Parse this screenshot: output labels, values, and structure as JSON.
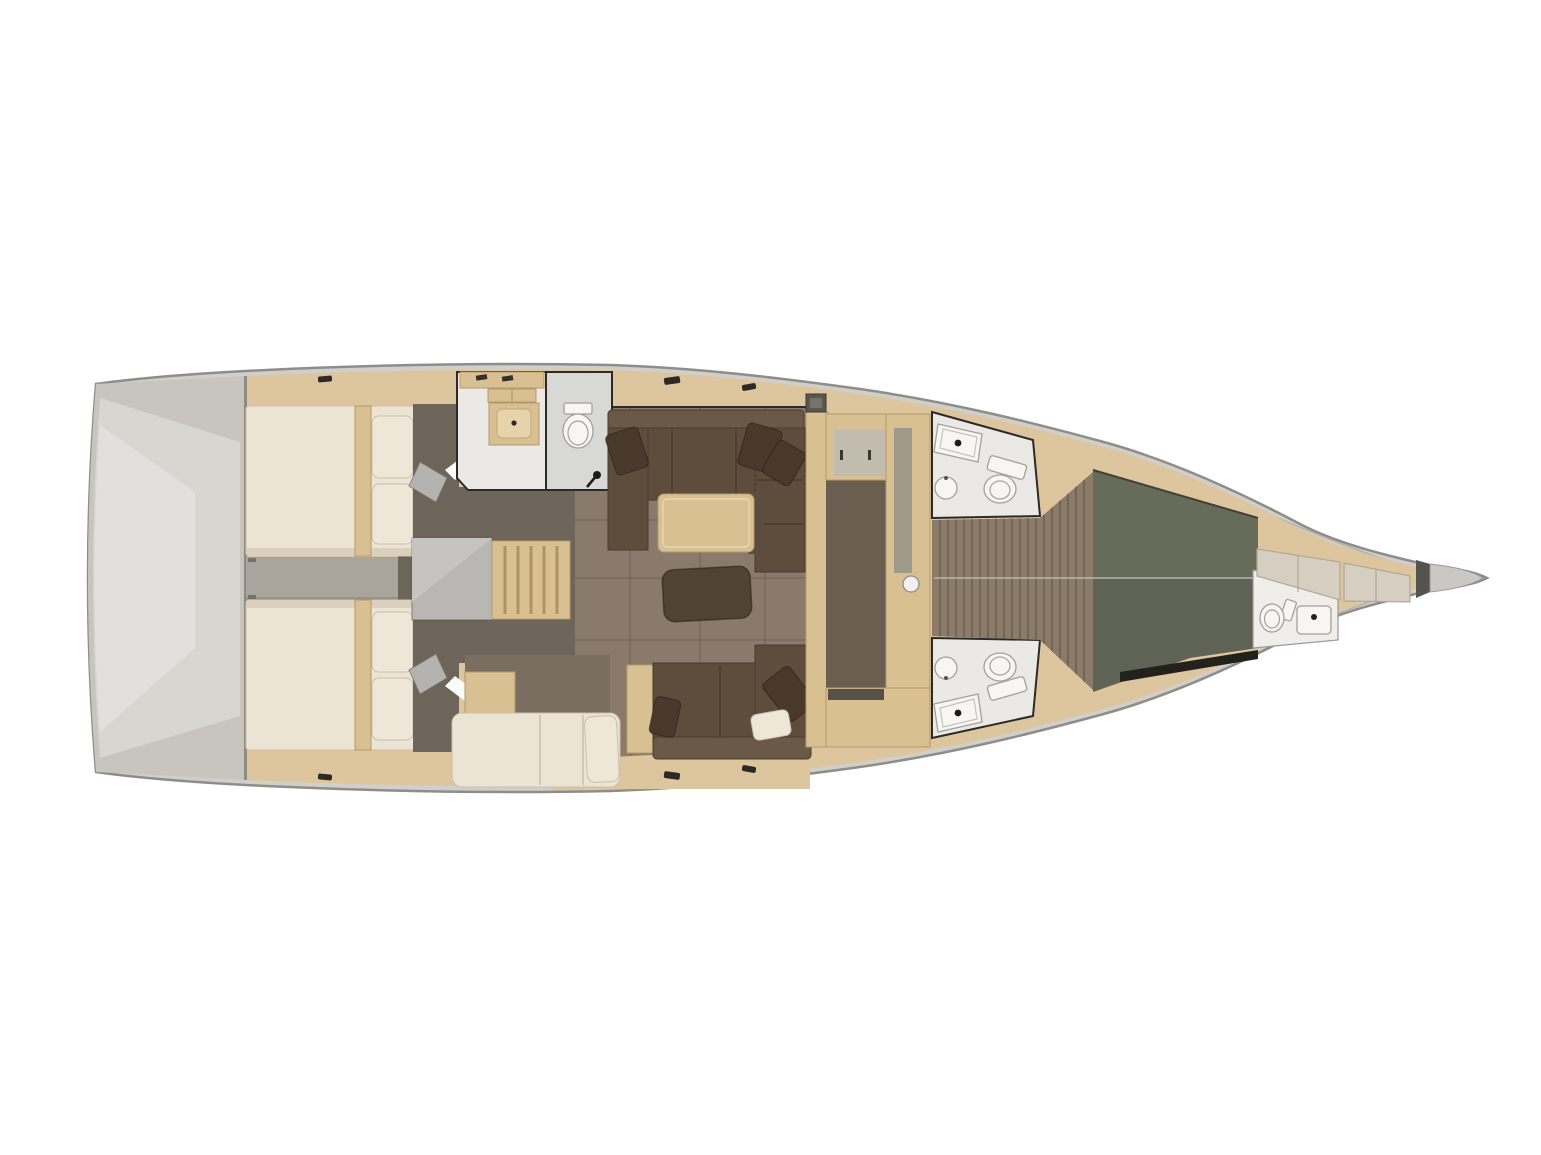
{
  "labels": {
    "plan": "sailing-yacht-interior-layout-plan",
    "hull": "hull-outline",
    "transom": "stern-swim-platform",
    "aft_cabin_top": "aft-double-cabin-port",
    "aft_cabin_bottom": "aft-double-cabin-starboard",
    "engine": "engine-compartment-corridor",
    "aft_head": "aft-bathroom-with-shower",
    "companionway": "companionway-steps",
    "nav": "chart-table-and-settee",
    "salon": "salon-seating-area",
    "galley": "galley",
    "head_top": "midship-bathroom-port",
    "head_bottom": "midship-bathroom-starboard",
    "walkway": "owner-cabin-walkway",
    "fwd_cabin": "owner-cabin-double-berth",
    "fwd_head": "bow-crew-compartment",
    "bow": "anchor-locker"
  },
  "palette": {
    "bg": "#ffffff",
    "hull_rim": "#d1cfcb",
    "hull_line": "#8f8d89",
    "hull_inner": "#b2b0ac",
    "wood_deck": "#ddc69e",
    "wood_furniture": "#d9c092",
    "wood_edge": "#b5996a",
    "ladder_line": "#b0935f",
    "transom": "#c8c5bf",
    "transom_light": "#d8d6d1",
    "transom_lighter": "#e2e0dc",
    "bed_cream": "#ebe3d3",
    "bed_shade": "#d9d0bd",
    "pillow_cream": "#eee7d8",
    "pillow_edge": "#c9c0ab",
    "corridor": "#a9a59d",
    "dark_taupe": "#6e655a",
    "platform_gray": "#b9b7b3",
    "salon_floor": "#897a6c",
    "sofa": "#5e4d3d",
    "sofa_back": "#6b5948",
    "sofa_line": "#483a2c",
    "pillow_dark": "#48392b",
    "ottoman": "#514236",
    "galley_sole": "#6b5e51",
    "counter_gray": "#c2bcae",
    "counter_gray2": "#a09a8a",
    "stove": "#55524a",
    "head_floor": "#ebe9e5",
    "head_floor2": "#d8d8d5",
    "fixture_white": "#f7f6f3",
    "fixture_line": "#a3a19d",
    "wall_dark": "#2b2a26",
    "slat_floor": "#8b7c6a",
    "slat_line": "#5e5346",
    "fwd_bed": "#5f6355",
    "fwd_bed_light": "#676b5a",
    "shadow_dark": "#23211c",
    "cushion": "#d6cec1",
    "cushion_edge": "#b1a897",
    "bulkhead": "#55534e",
    "bow_gray": "#cac8c4",
    "seam_light": "#c6c3b6",
    "door_gray": "#b5b3af",
    "door_white": "#fbfbfa"
  }
}
